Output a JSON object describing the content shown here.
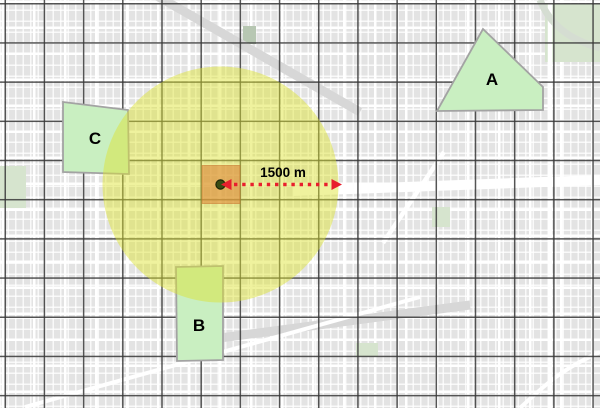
{
  "annotations": {
    "distance_label": "1500 m"
  },
  "zones": [
    {
      "label": "A"
    },
    {
      "label": "B"
    },
    {
      "label": "C"
    }
  ],
  "colors": {
    "map_background": "#e3e3e3",
    "street": "#ffffff",
    "rail_band": "#d7d7d7",
    "park": "#d6e4ce",
    "river": "#d5ddd2",
    "graticule": "#373737",
    "zone_fill": "#c9efc1",
    "zone_border": "#a3a3a3",
    "buffer_fill": "#dde330",
    "impact_fill": "#df8a3c",
    "impact_border": "#c8772e",
    "center_dot": "#394c13",
    "center_dot_border": "#1d2607",
    "arrow": "#e81f2d",
    "label_color": "#000000"
  }
}
